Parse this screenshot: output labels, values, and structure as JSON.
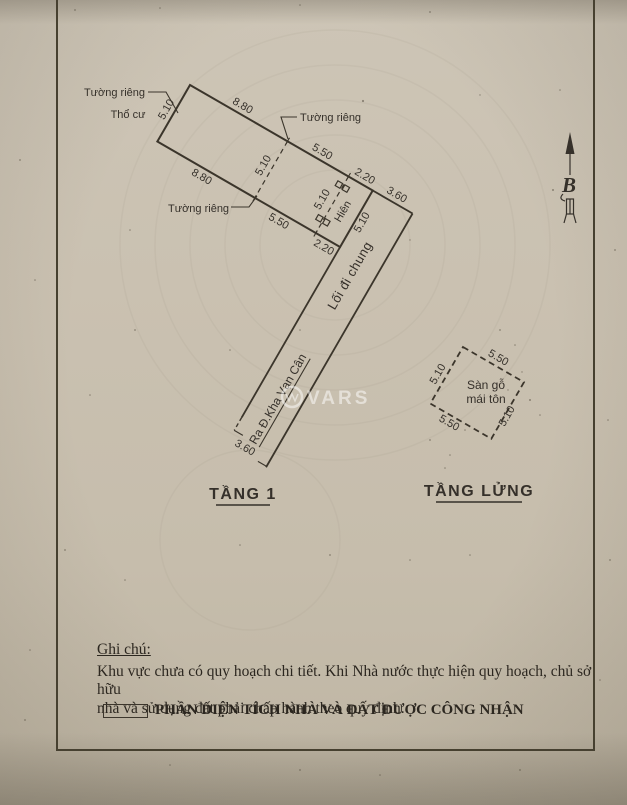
{
  "colors": {
    "paper": "#c9c0af",
    "ink": "#35302a"
  },
  "compass": {
    "letter": "B"
  },
  "watermark": {
    "text": "VARS"
  },
  "plan": {
    "walls": {
      "top_left": "Tường riêng",
      "top_right": "Tường riêng",
      "bottom": "Tường riêng"
    },
    "land_type": "Thổ cư",
    "porch": "Hiên",
    "corridor": "Lối đi chung",
    "street": "Ra Đ.Kha Vạn Cân",
    "floor1": "TẦNG 1",
    "mezzanine": "TẦNG LỬNG",
    "mezzanine_material": [
      "Sàn gỗ",
      "mái tôn"
    ],
    "dims": {
      "building_top": [
        "8.80",
        "5.50",
        "2.20"
      ],
      "building_bottom": [
        "8.80",
        "5.50",
        "2.20"
      ],
      "building_left": "5.10",
      "divider_main": "5.10",
      "divider_porch": "5.10",
      "building_right": "5.10",
      "corridor_top": "3.60",
      "corridor_end": "3.60",
      "mezz_top": "5.50",
      "mezz_bottom": "5.50",
      "mezz_left": "5.10",
      "mezz_right": "5.10"
    }
  },
  "notes": {
    "heading": "Ghi chú:",
    "line1": "Khu vực chưa có quy hoạch chi tiết. Khi Nhà nước thực hiện quy hoạch, chủ sở hữu",
    "line2": "nhà và sử dụng đất phải chấp hành theo quy định.",
    "legend_label": "PHẦN DIỆN TÍCH NHÀ VÀ ĐẤT ĐƯỢC CÔNG NHẬN"
  }
}
